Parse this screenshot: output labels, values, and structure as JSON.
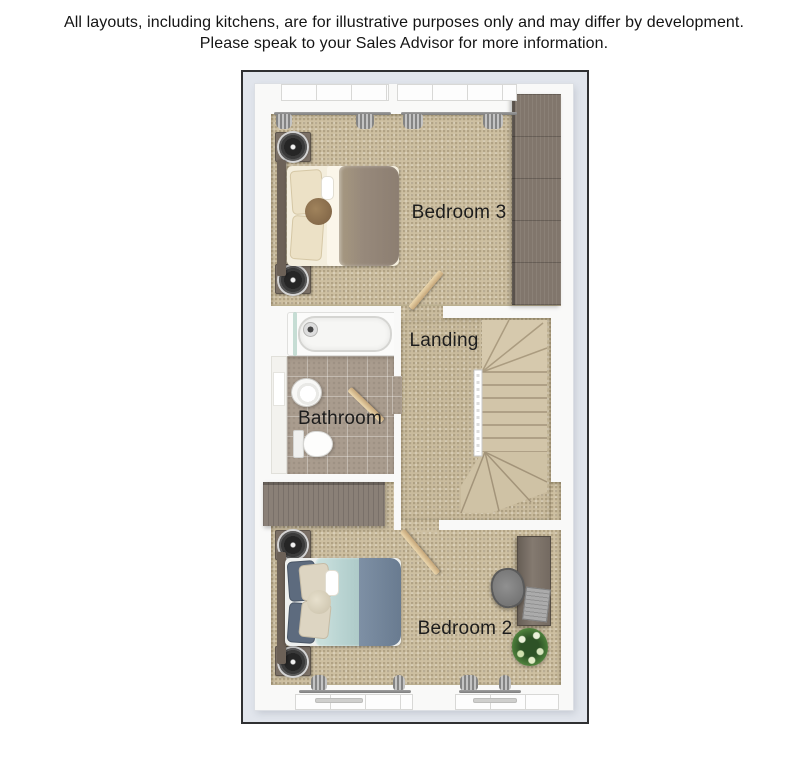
{
  "disclaimer": {
    "line1": "All layouts, including kitchens, are for illustrative purposes only and may differ by development.",
    "line2": "Please speak to your Sales Advisor for more information."
  },
  "floorplan": {
    "rooms": [
      {
        "id": "bedroom3",
        "label": "Bedroom 3"
      },
      {
        "id": "landing",
        "label": "Landing"
      },
      {
        "id": "bathroom",
        "label": "Bathroom"
      },
      {
        "id": "bedroom2",
        "label": "Bedroom 2"
      }
    ],
    "furniture": [
      "double-bed",
      "bedside-table",
      "table-lamp",
      "wardrobe",
      "curtains",
      "bathtub",
      "basin",
      "toilet",
      "staircase",
      "door",
      "desk",
      "office-chair",
      "laptop",
      "plant"
    ],
    "colors": {
      "plan_border": "#2f3032",
      "mat": "#e1e5ec",
      "wall": "#f9f9f8",
      "carpet": "#cdbfa1",
      "tile": "#a99c8e",
      "wardrobe_wood": "#81766c",
      "door_wood": "#d8bb8d",
      "bed3_duvet": "#97897b",
      "bed2_duvet": "#b9d4d2",
      "bed2_throw": "#74869b",
      "stairs": "#d2c5a9",
      "plant_green": "#477a38"
    }
  }
}
